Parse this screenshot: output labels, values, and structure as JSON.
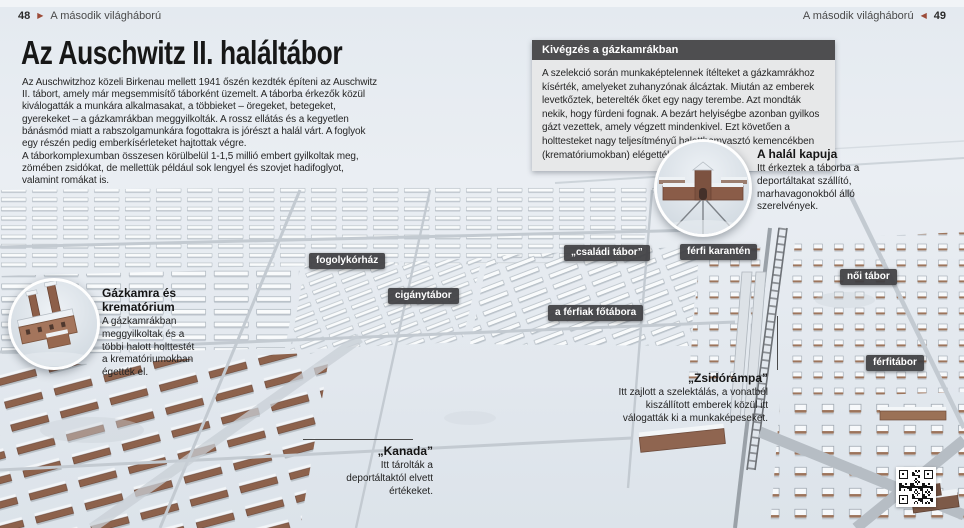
{
  "page": {
    "header_left": {
      "page_number": "48",
      "arrow": "▶",
      "section": "A második világháború"
    },
    "header_right": {
      "section": "A második világháború",
      "arrow": "◀",
      "page_number": "49"
    }
  },
  "article": {
    "title": "Az Auschwitz II. haláltábor",
    "paragraphs": [
      "Az Auschwitzhoz közeli Birkenau mellett 1941 őszén kezdték építeni az Auschwitz II. tábort, amely már megsemmisítő táborként üzemelt. A táborba érkezők közül kiválogatták a munkára alkalmasakat, a többieket – öregeket, betegeket, gyerekeket – a gázkamrákban meggyilkolták. A rossz ellátás és a kegyetlen bánásmód miatt a rabszolgamunkára fogottakra is jórészt a halál várt. A foglyok egy részén pedig emberkísérleteket hajtottak végre.",
      "A táborkomplexumban összesen körülbelül 1-1,5 millió embert gyilkoltak meg, zömében zsidókat, de mellettük például sok lengyel és szovjet hadifoglyot, valamint romákat is."
    ]
  },
  "infobox": {
    "title": "Kivégzés a gázkamrákban",
    "body": "A szelekció során munkaképtelennek ítélteket a gázkamrákhoz kísérték, amelyeket zuhanyzónak álcáztak. Miután az emberek levetkőztek, beterelték őket egy nagy terembe. Azt mondták nekik, hogy fürdeni fognak. A bezárt helyiségbe azonban gyilkos gázt vezettek, amely végzett mindenkivel. Ezt követően a holttesteket nagy teljesítményű halotthamvasztó kemencékben (krematóriumokban) elégették."
  },
  "callouts": {
    "death_gate": {
      "title": "A halál kapuja",
      "body": "Itt érkeztek a táborba a deportáltakat szállító, marhavagonokból álló szerelvények."
    },
    "gas_chamber": {
      "title": "Gázkamra és krematórium",
      "body": "A gázkamrákban meggyilkoltak és a többi halott holttestét a krematóriumokban égették el."
    },
    "jew_ramp": {
      "title": "„Zsidórámpa”",
      "body": "Itt zajlott a szelektálás, a vonatból kiszállított emberek közül itt válogatták ki a munkaképeseket."
    },
    "kanada": {
      "title": "„Kanada”",
      "body": "Itt tárolták a deportáltaktól elvett értékeket."
    }
  },
  "map_labels": [
    {
      "text": "fogolykórház"
    },
    {
      "text": "cigánytábor"
    },
    {
      "text": "„családi tábor”"
    },
    {
      "text": "férfi karantén"
    },
    {
      "text": "női tábor"
    },
    {
      "text": "a férfiak főtábora"
    },
    {
      "text": "férfitábor"
    }
  ],
  "icons": {
    "qr_code": "qr-code",
    "forward_triangle": "triangle-right-icon",
    "back_triangle": "triangle-left-icon"
  },
  "colors": {
    "accent_arrow": "#9c4b38",
    "infobox_header_bg": "#4e4e50",
    "infobox_body_bg": "#e7e8e9",
    "map_label_bg": "#3e3e42",
    "snow_background": "#e6ebf0",
    "brick_building": "#8d624c",
    "text_dark": "#262626"
  }
}
